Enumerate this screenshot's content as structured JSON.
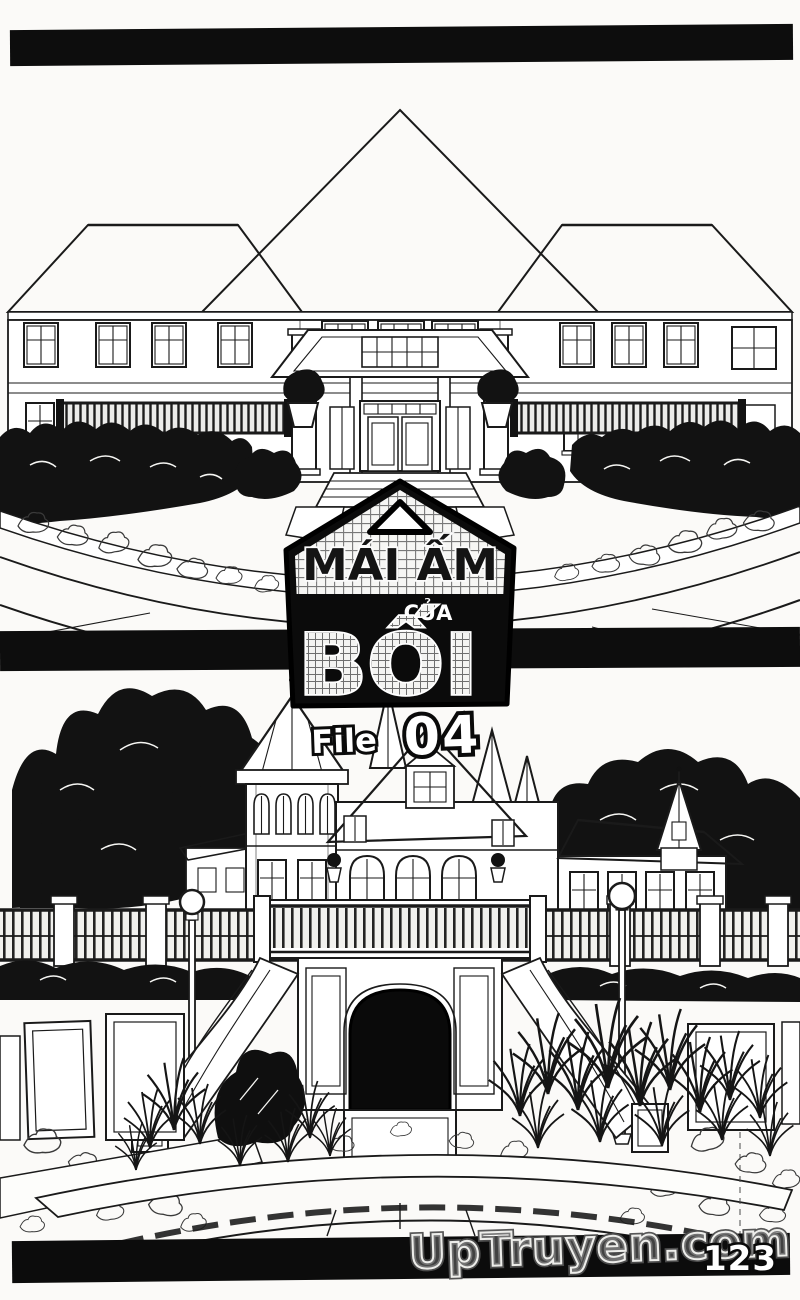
{
  "scan": {
    "paper_color": "#fbfaf8",
    "ink_color": "#141414",
    "page_number": "123"
  },
  "chapter_logo": {
    "badge_shape": "house-pentagon-with-triangle-vent",
    "title_top": "MÁI ẤM",
    "title_middle": "CỦA",
    "title_bottom": "BỐI",
    "file_label": "File",
    "file_number": "04"
  },
  "watermark": {
    "text": "UpTruyen.com"
  },
  "artwork": {
    "top_illustration": "western-mansion-hip-tiled-roof-portico-columns-hedges-grand-steps-curved-courtyard",
    "bottom_illustration": "castle-mansion-turret-spires-trees-fence-lamps-grand-stair-arch-grass-stone-paving"
  }
}
